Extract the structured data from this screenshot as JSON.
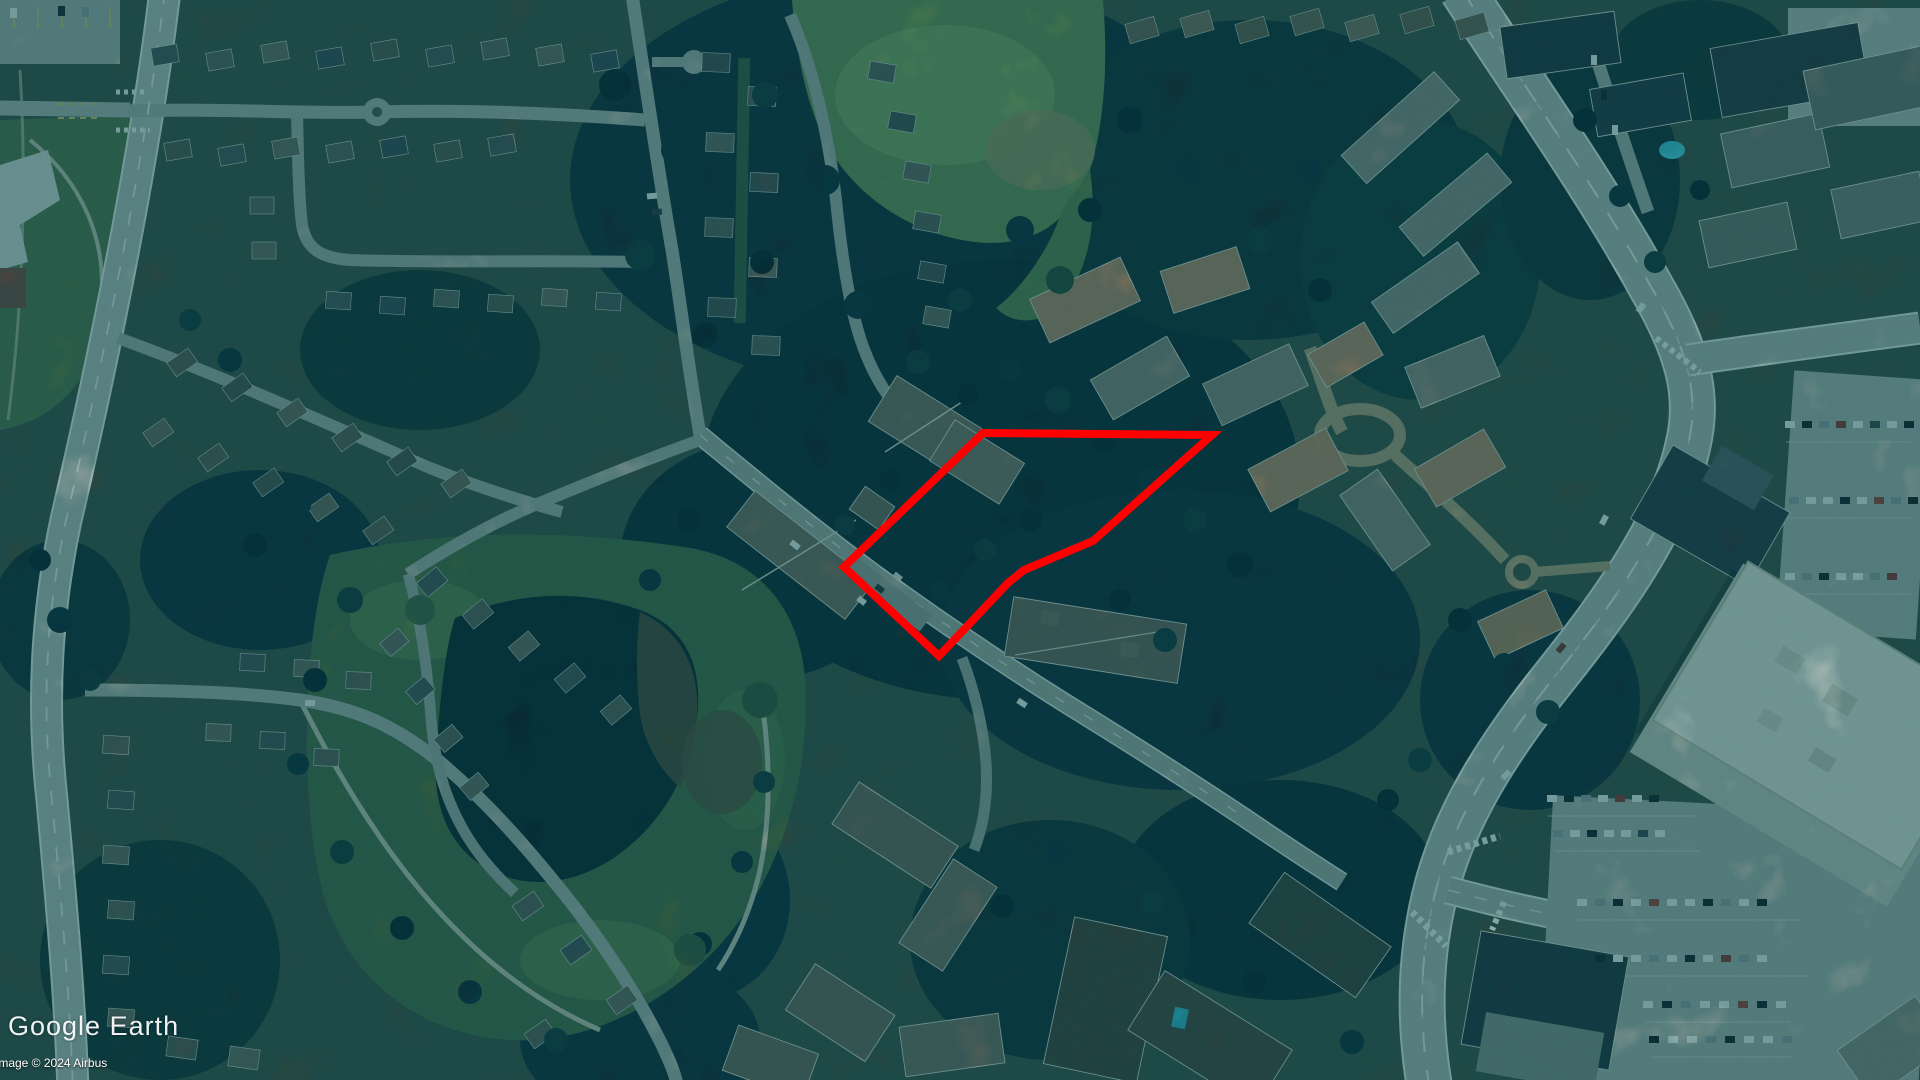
{
  "app": {
    "watermark": "Google Earth",
    "copyright": "Image © 2024 Airbus"
  },
  "highlight": {
    "color": "#ff0000",
    "stroke_width": "8",
    "points_str": "983,433 1212,435 1093,541 1024,570 1008,583 939,656 844,567"
  },
  "map": {
    "view": "satellite aerial",
    "features": [
      "residential neighbourhoods",
      "conifer forest",
      "grass playing field",
      "pond and park",
      "townhouse complexes",
      "shopping centre",
      "parking lots with cars",
      "arterial roads"
    ]
  }
}
